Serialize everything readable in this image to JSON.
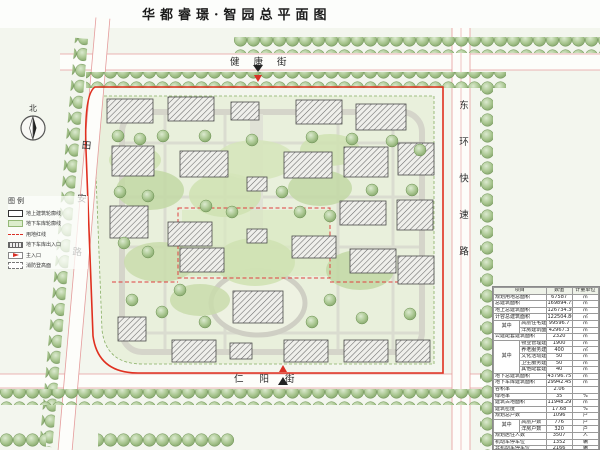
{
  "title": "华都睿璟·智园总平面图",
  "north": {
    "label": "北"
  },
  "streets": {
    "top": "健康街",
    "bottom": "仁阳街",
    "left": "田安路",
    "right": "东环快速路"
  },
  "legend": {
    "title": "图例",
    "items": [
      {
        "symbol": "building-outline",
        "label": "地上建筑轮廓线"
      },
      {
        "symbol": "garage-outline",
        "label": "地下车库轮廓线"
      },
      {
        "symbol": "red-line",
        "label": "用地红线"
      },
      {
        "symbol": "garage-entrance",
        "label": "地下车库出入口"
      },
      {
        "symbol": "main-entrance",
        "label": "主入口"
      },
      {
        "symbol": "fire-lane",
        "label": "消防登高面"
      }
    ]
  },
  "colors": {
    "red_line": "#e03020",
    "garage_fill": "#e9f0dc",
    "tree_green": "#9cc07e",
    "road_edge_pink": "#e59c9c"
  },
  "table": {
    "headers": [
      "项目",
      "数值",
      "计量单位"
    ],
    "rows": [
      {
        "label": "规划用地总面积",
        "value": "67587",
        "unit": "㎡"
      },
      {
        "label": "总建筑面积",
        "value": "169894.75",
        "unit": "㎡"
      },
      {
        "label": "地上总建筑面积",
        "value": "126734.36",
        "unit": "㎡"
      },
      {
        "label": "计容总建筑面积",
        "value": "122504.86",
        "unit": "㎡"
      },
      {
        "label": "高层住宅建筑面积",
        "value": "99596.7",
        "unit": "㎡",
        "group": "其中",
        "span": 2
      },
      {
        "label": "洋房建筑面积",
        "value": "42967.3",
        "unit": "㎡",
        "sub": true
      },
      {
        "label": "公建配套建筑面积",
        "value": "2320",
        "unit": "㎡"
      },
      {
        "label": "物业管理建筑面积",
        "value": "1900",
        "unit": "㎡",
        "group": "其中",
        "span": 5
      },
      {
        "label": "养老服务建筑面积",
        "value": "400",
        "unit": "㎡",
        "sub": true
      },
      {
        "label": "文化活动建筑面积",
        "value": "50",
        "unit": "㎡",
        "sub": true
      },
      {
        "label": "卫生服务建筑面积",
        "value": "50",
        "unit": "㎡",
        "sub": true
      },
      {
        "label": "其他配套建筑面积",
        "value": "40",
        "unit": "㎡",
        "sub": true
      },
      {
        "label": "地下总建筑面积",
        "value": "43796.75",
        "unit": "㎡"
      },
      {
        "label": "地下车库建筑面积",
        "value": "29942.45",
        "unit": "㎡"
      },
      {
        "label": "容积率",
        "value": "2.06",
        "unit": ""
      },
      {
        "label": "绿地率",
        "value": "35",
        "unit": "%"
      },
      {
        "label": "建筑占地面积",
        "value": "11948.29",
        "unit": "㎡"
      },
      {
        "label": "建筑密度",
        "value": "17.68",
        "unit": "%"
      },
      {
        "label": "规划总户数",
        "value": "1096",
        "unit": "户"
      },
      {
        "label": "高层户数",
        "value": "776",
        "unit": "户",
        "group": "其中",
        "span": 2
      },
      {
        "label": "洋房户数",
        "value": "320",
        "unit": "户",
        "sub": true
      },
      {
        "label": "规划居住人数",
        "value": "3507",
        "unit": "人"
      },
      {
        "label": "机动车停车位",
        "value": "1352",
        "unit": "辆"
      },
      {
        "label": "非机动车停车位",
        "value": "2166",
        "unit": "辆"
      }
    ]
  }
}
